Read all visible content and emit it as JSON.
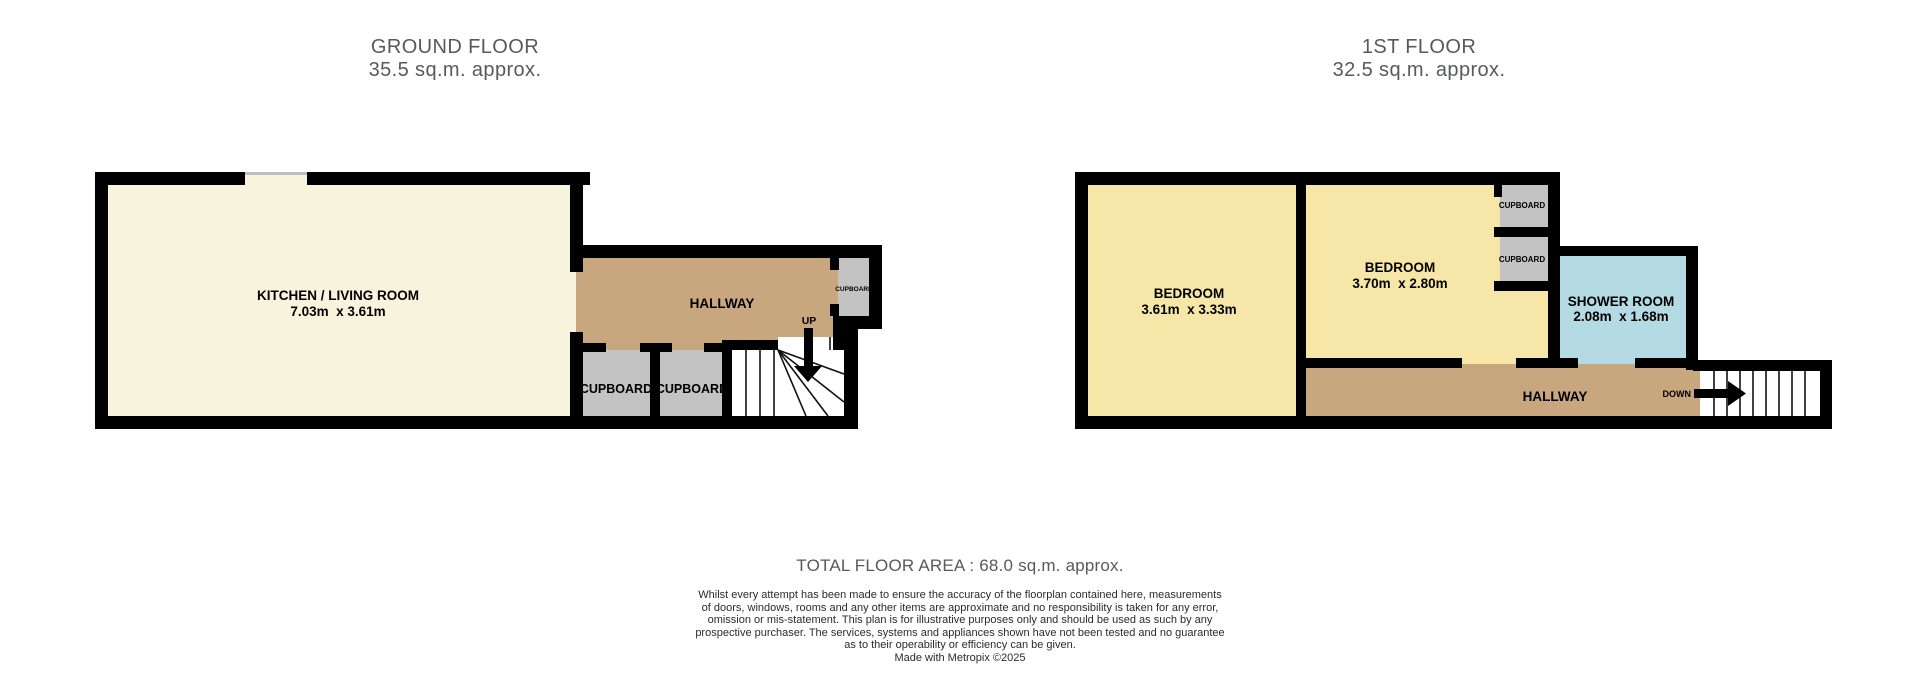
{
  "colors": {
    "wall": "#000000",
    "kitchen": "#F8F3DC",
    "bedroom": "#F6E6A7",
    "hallway": "#C8A77E",
    "cupboard": "#C3C3C3",
    "shower": "#B4DAE3",
    "stairs": "#FFFFFF",
    "title_text": "#58595B",
    "room_text": "#000000",
    "disclaimer_text": "#2B2B2B"
  },
  "ground_floor": {
    "title": "GROUND FLOOR",
    "area": "35.5 sq.m. approx.",
    "rooms": {
      "kitchen_living": {
        "name": "KITCHEN / LIVING ROOM",
        "dimensions": "7.03m  x 3.61m"
      },
      "hallway": {
        "name": "HALLWAY"
      },
      "cupboard_1": {
        "name": "CUPBOARD"
      },
      "cupboard_2": {
        "name": "CUPBOARD"
      },
      "cupboard_small": {
        "name": "CUPBOARD"
      }
    },
    "stairs_label": "UP"
  },
  "first_floor": {
    "title": "1ST FLOOR",
    "area": "32.5 sq.m. approx.",
    "rooms": {
      "bedroom_1": {
        "name": "BEDROOM",
        "dimensions": "3.61m  x 3.33m"
      },
      "bedroom_2": {
        "name": "BEDROOM",
        "dimensions": "3.70m  x 2.80m"
      },
      "shower_room": {
        "name": "SHOWER ROOM",
        "dimensions": "2.08m  x 1.68m"
      },
      "hallway": {
        "name": "HALLWAY"
      },
      "cupboard_1": {
        "name": "CUPBOARD"
      },
      "cupboard_2": {
        "name": "CUPBOARD"
      }
    },
    "stairs_label": "DOWN"
  },
  "footer": {
    "total_area": "TOTAL FLOOR AREA : 68.0 sq.m. approx.",
    "disclaimer_lines": [
      "Whilst every attempt has been made to ensure the accuracy of the floorplan contained here, measurements",
      "of doors, windows, rooms and any other items are approximate and no responsibility is taken for any error,",
      "omission or mis-statement. This plan is for illustrative purposes only and should be used as such by any",
      "prospective purchaser. The services, systems and appliances shown have not been tested and no guarantee",
      "as to their operability or efficiency can be given.",
      "Made with Metropix ©2025"
    ]
  }
}
